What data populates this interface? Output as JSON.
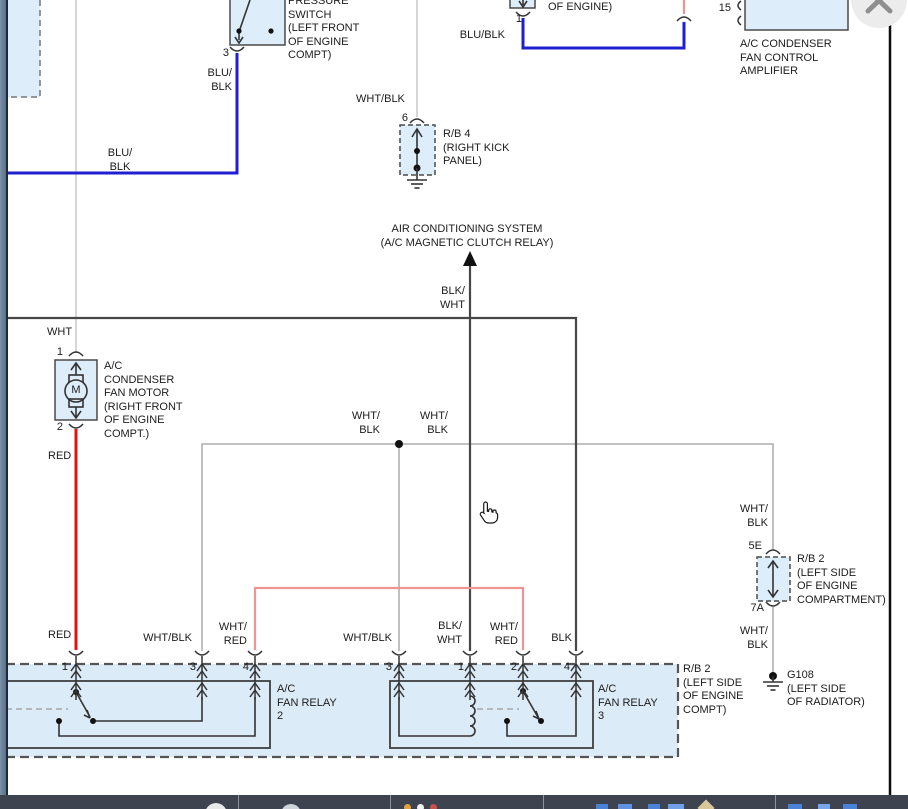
{
  "colors": {
    "wire_blue": "#1f1fd0",
    "wire_red": "#e01212",
    "wire_pink": "#f09393",
    "wire_white": "#cccccc",
    "wire_white_black": "#b9b9b9",
    "wire_black": "#474747",
    "component_fill": "#ddeefa",
    "region_fill": "#dcebf8",
    "taskbar_bg": "#3d4450",
    "close_button_bg": "#ececec",
    "close_button_glyph": "#8f8f8f"
  },
  "diagram": {
    "labels": [
      {
        "id": "pressure-switch-label",
        "text": "PRESSURE\nSWITCH\n(LEFT FRONT\nOF ENGINE\nCOMPT)",
        "x": 288,
        "y": -5,
        "align": "left"
      },
      {
        "id": "of-engine-label",
        "text": "OF ENGINE)",
        "x": 548,
        "y": 1,
        "align": "left"
      },
      {
        "id": "pin-1-top",
        "text": "1",
        "x": 522,
        "y": 13,
        "align": "right"
      },
      {
        "id": "blu-blk-mid",
        "text": "BLU/BLK",
        "x": 505,
        "y": 29,
        "align": "right"
      },
      {
        "id": "pin-15",
        "text": "15",
        "x": 731,
        "y": 2,
        "align": "right"
      },
      {
        "id": "amplifier-label",
        "text": "A/C CONDENSER\nFAN CONTROL\nAMPLIFIER",
        "x": 740,
        "y": 38,
        "align": "left"
      },
      {
        "id": "pin-3-pressure",
        "text": "3",
        "x": 229,
        "y": 47,
        "align": "right"
      },
      {
        "id": "blu-blk-switch",
        "text": "BLU/\nBLK",
        "x": 232,
        "y": 67,
        "align": "right"
      },
      {
        "id": "wht-blk-top",
        "text": "WHT/BLK",
        "x": 356,
        "y": 93,
        "align": "left"
      },
      {
        "id": "pin-6",
        "text": "6",
        "x": 408,
        "y": 112,
        "align": "right"
      },
      {
        "id": "rb4-label",
        "text": "R/B 4\n(RIGHT KICK\nPANEL)",
        "x": 443,
        "y": 128,
        "align": "left"
      },
      {
        "id": "blu-blk-left",
        "text": "BLU/\nBLK",
        "x": 120,
        "y": 147,
        "align": "center"
      },
      {
        "id": "ac-system-label",
        "text": "AIR CONDITIONING SYSTEM\n(A/C MAGNETIC CLUTCH RELAY)",
        "x": 467,
        "y": 223,
        "align": "center"
      },
      {
        "id": "blk-wht-mid",
        "text": "BLK/\nWHT",
        "x": 465,
        "y": 285,
        "align": "right"
      },
      {
        "id": "wht-label",
        "text": "WHT",
        "x": 47,
        "y": 326,
        "align": "left"
      },
      {
        "id": "pin-1-motor",
        "text": "1",
        "x": 63,
        "y": 346,
        "align": "right"
      },
      {
        "id": "motor-label",
        "text": "A/C\nCONDENSER\nFAN MOTOR\n(RIGHT FRONT\nOF ENGINE\nCOMPT.)",
        "x": 104,
        "y": 360,
        "align": "left"
      },
      {
        "id": "motor-m",
        "text": "M",
        "x": 76,
        "y": 384,
        "align": "center"
      },
      {
        "id": "pin-2-motor",
        "text": "2",
        "x": 63,
        "y": 421,
        "align": "right"
      },
      {
        "id": "red-label-1",
        "text": "RED",
        "x": 48,
        "y": 450,
        "align": "left"
      },
      {
        "id": "wht-blk-net-1",
        "text": "WHT/\nBLK",
        "x": 380,
        "y": 410,
        "align": "right"
      },
      {
        "id": "wht-blk-net-2",
        "text": "WHT/\nBLK",
        "x": 448,
        "y": 410,
        "align": "right"
      },
      {
        "id": "wht-blk-rb2",
        "text": "WHT/\nBLK",
        "x": 768,
        "y": 503,
        "align": "right"
      },
      {
        "id": "pin-5e",
        "text": "5E",
        "x": 762,
        "y": 540,
        "align": "right"
      },
      {
        "id": "rb2-upper-label",
        "text": "R/B 2\n(LEFT SIDE\nOF ENGINE\nCOMPARTMENT)",
        "x": 797,
        "y": 553,
        "align": "left"
      },
      {
        "id": "pin-7a",
        "text": "7A",
        "x": 764,
        "y": 602,
        "align": "right"
      },
      {
        "id": "wht-blk-g108",
        "text": "WHT/\nBLK",
        "x": 768,
        "y": 625,
        "align": "right"
      },
      {
        "id": "g108-label",
        "text": "G108\n(LEFT SIDE\nOF RADIATOR)",
        "x": 787,
        "y": 669,
        "align": "left"
      },
      {
        "id": "red-label-2",
        "text": "RED",
        "x": 48,
        "y": 629,
        "align": "left"
      },
      {
        "id": "wht-blk-pin3a",
        "text": "WHT/BLK",
        "x": 192,
        "y": 632,
        "align": "right"
      },
      {
        "id": "wht-red-pin4a",
        "text": "WHT/\nRED",
        "x": 247,
        "y": 621,
        "align": "right"
      },
      {
        "id": "wht-blk-pin3b",
        "text": "WHT/BLK",
        "x": 392,
        "y": 632,
        "align": "right"
      },
      {
        "id": "blk-wht-pin1",
        "text": "BLK/\nWHT",
        "x": 462,
        "y": 620,
        "align": "right"
      },
      {
        "id": "wht-red-pin2",
        "text": "WHT/\nRED",
        "x": 518,
        "y": 621,
        "align": "right"
      },
      {
        "id": "blk-pin4",
        "text": "BLK",
        "x": 572,
        "y": 632,
        "align": "right"
      },
      {
        "id": "pin-1-relay2",
        "text": "1",
        "x": 68,
        "y": 661,
        "align": "right"
      },
      {
        "id": "pin-3-relay2",
        "text": "3",
        "x": 196,
        "y": 661,
        "align": "right"
      },
      {
        "id": "pin-4-relay2",
        "text": "4",
        "x": 249,
        "y": 661,
        "align": "right"
      },
      {
        "id": "pin-3-relay3",
        "text": "3",
        "x": 392,
        "y": 661,
        "align": "right"
      },
      {
        "id": "pin-1-relay3",
        "text": "1",
        "x": 464,
        "y": 661,
        "align": "right"
      },
      {
        "id": "pin-2-relay3",
        "text": "2",
        "x": 517,
        "y": 661,
        "align": "right"
      },
      {
        "id": "pin-4-relay3",
        "text": "4",
        "x": 570,
        "y": 661,
        "align": "right"
      },
      {
        "id": "relay2-label",
        "text": "A/C\nFAN RELAY\n2",
        "x": 277,
        "y": 683,
        "align": "left"
      },
      {
        "id": "relay3-label",
        "text": "A/C\nFAN RELAY\n3",
        "x": 598,
        "y": 683,
        "align": "left"
      },
      {
        "id": "rb2-bottom-label",
        "text": "R/B 2\n(LEFT SIDE\nOF ENGINE\nCOMPT)",
        "x": 683,
        "y": 663,
        "align": "left"
      }
    ]
  }
}
